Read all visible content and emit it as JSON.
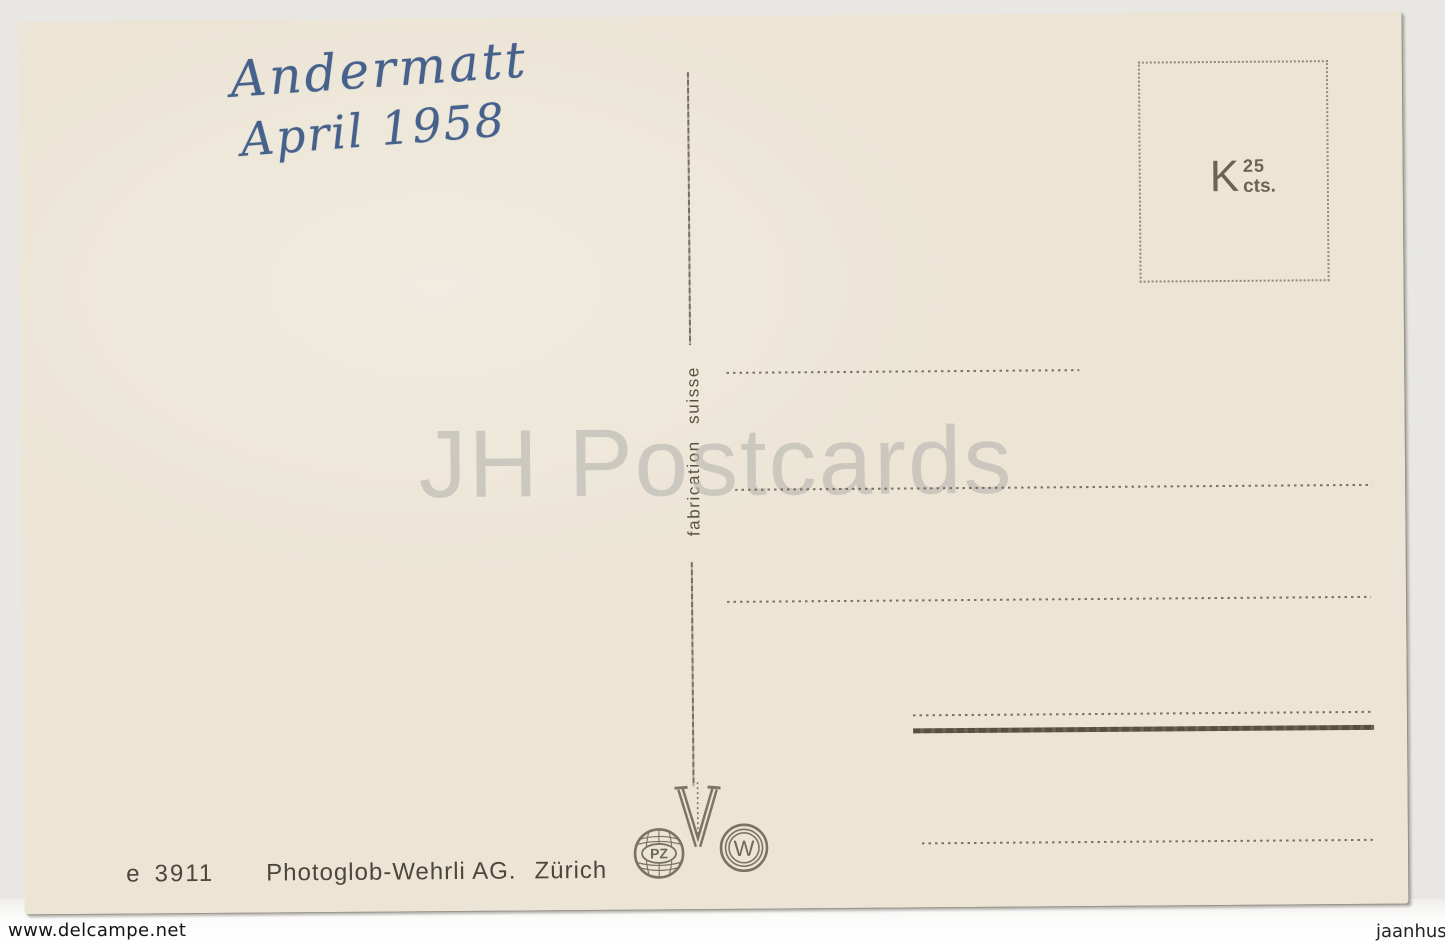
{
  "postcard": {
    "handwriting": {
      "line1": "Andermatt",
      "line2": "April 1958",
      "ink_color": "#46618b"
    },
    "stamp_box": {
      "letter": "K",
      "value": "25",
      "unit": "cts."
    },
    "divider_label": "fabrication suisse",
    "watermark_text": "JH Postcards",
    "publisher": {
      "code_letter": "e",
      "code_number": "3911",
      "name": "Photoglob-Wehrli AG.",
      "city": "Zürich"
    },
    "logos": {
      "pz": "PZ",
      "w": "W"
    },
    "address_panel": {
      "dashed_address_lines": 3,
      "dashed_sender_lines": 2,
      "thick_rule_lines": 1
    },
    "colors": {
      "card_paper": "#ece5d6",
      "print_ink": "#6e6557",
      "handwriting_ink": "#46618b",
      "brand_watermark": "#b7b6b0"
    }
  },
  "footer": {
    "left": "www.delcampe.net",
    "right": "jaanhus"
  }
}
